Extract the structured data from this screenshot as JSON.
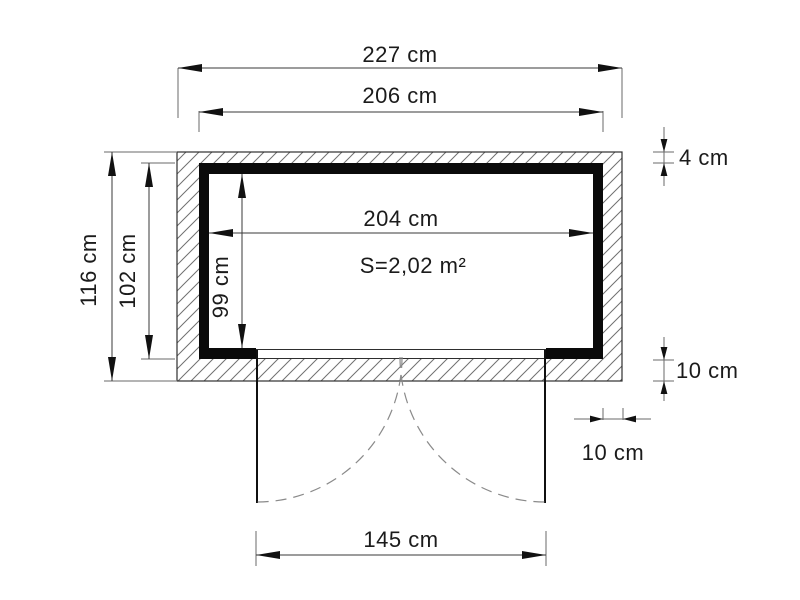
{
  "plan": {
    "area_label": "S=2,02 m²",
    "dimensions": {
      "total_width": "227 cm",
      "frame_outer_width": "206 cm",
      "interior_width": "204 cm",
      "total_depth": "116 cm",
      "frame_outer_depth": "102 cm",
      "interior_depth": "99 cm",
      "front_wall_thickness": "4 cm",
      "base_thickness_vertical": "10 cm",
      "base_thickness_horizontal": "10 cm",
      "door_opening_width": "145 cm"
    },
    "colors": {
      "wall_fill": "#0a0a0a",
      "hatch_line": "#707070",
      "dimension_line": "#3a3a3a",
      "text": "#1b1b1b",
      "background": "#ffffff"
    }
  }
}
